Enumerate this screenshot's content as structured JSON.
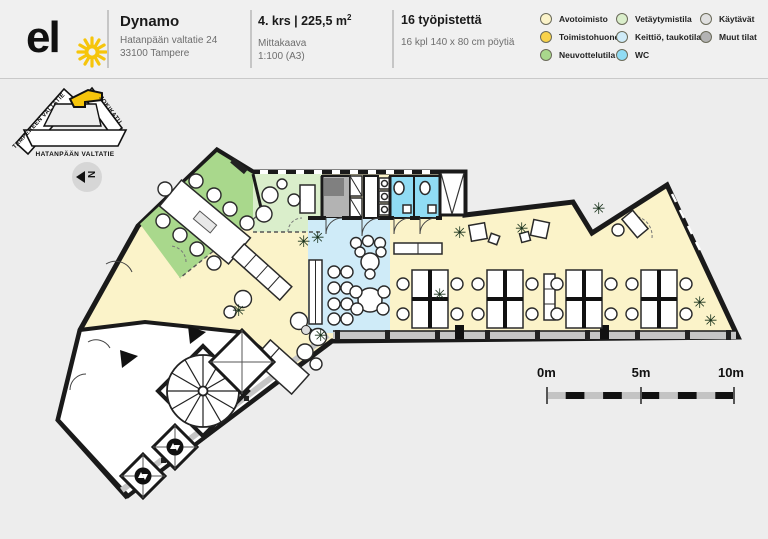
{
  "header": {
    "logo": {
      "text": "el"
    },
    "building": {
      "title": "Dynamo",
      "address_line1": "Hatanpään valtatie 24",
      "address_line2": "33100 Tampere"
    },
    "floor": {
      "area_title_prefix": "4. krs | 225,5 m",
      "area_sup": "2",
      "scale_label": "Mittakaava",
      "scale_value": "1:100 (A3)"
    },
    "workstations": {
      "title": "16 työpistettä",
      "subtitle": "16 kpl 140 x 80 cm pöytiä"
    }
  },
  "legend": {
    "items": [
      {
        "key": "avotoimisto",
        "label": "Avotoimisto"
      },
      {
        "key": "toimistohuone",
        "label": "Toimistohuone"
      },
      {
        "key": "neuvottelutila",
        "label": "Neuvottelutila"
      },
      {
        "key": "vetaytymistila",
        "label": "Vetäytymistila"
      },
      {
        "key": "keittio",
        "label": "Keittiö, taukotilat"
      },
      {
        "key": "wc",
        "label": "WC"
      },
      {
        "key": "kaytavat",
        "label": "Käytävät"
      },
      {
        "key": "muut",
        "label": "Muut tilat"
      }
    ],
    "colors": {
      "avotoimisto": "#fbf3c9",
      "toimistohuone": "#f8d24b",
      "neuvottelutila": "#a9d88c",
      "vetaytymistila": "#daeecb",
      "keittio": "#cfebf8",
      "wc": "#90dcf4",
      "kaytavat": "#e0e0e0",
      "muut": "#b3b3b3"
    },
    "accent_yellow": "#f6c50b"
  },
  "map": {
    "streets": {
      "street1": "TAMPEREEN VALTATIE",
      "street2": "JOKIKATU",
      "street3": "HATANPÄÄN VALTATIE"
    }
  },
  "north": {
    "label": "N"
  },
  "scalebar": {
    "label_0": "0m",
    "label_5": "5m",
    "label_10": "10m"
  },
  "icons": {
    "plant": "✳"
  }
}
